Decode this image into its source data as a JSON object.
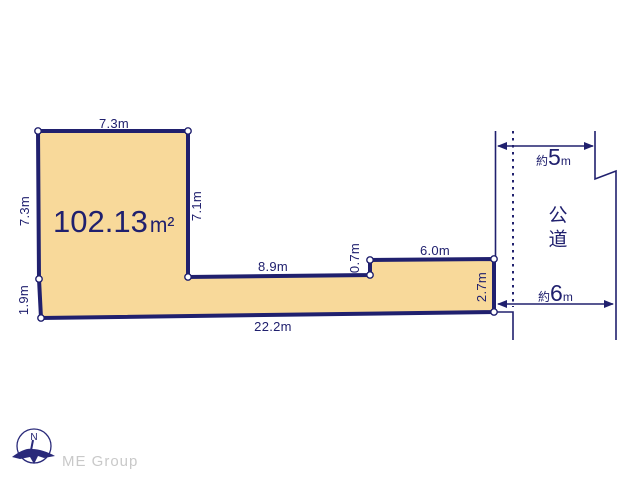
{
  "diagram": {
    "area_label": {
      "value": "102.13",
      "unit": "m²"
    },
    "dimensions": {
      "top": "7.3m",
      "left_upper": "7.3m",
      "square_right": "7.1m",
      "middle": "8.9m",
      "step": "0.7m",
      "strip_top": "6.0m",
      "right_lower": "2.7m",
      "bottom": "22.2m",
      "left_lower": "1.9m"
    },
    "road": {
      "name": "公道",
      "width_top": {
        "prefix": "約",
        "value": "5",
        "unit": "m"
      },
      "width_bottom": {
        "prefix": "約",
        "value": "6",
        "unit": "m"
      }
    },
    "compass": {
      "north": "N"
    },
    "watermark": "ME Group",
    "colors": {
      "line_navy": "#20206e",
      "lot_fill": "#f8d99a",
      "vertex_dot": "#ffffff",
      "watermark_gray": "#c9c9c9"
    }
  }
}
